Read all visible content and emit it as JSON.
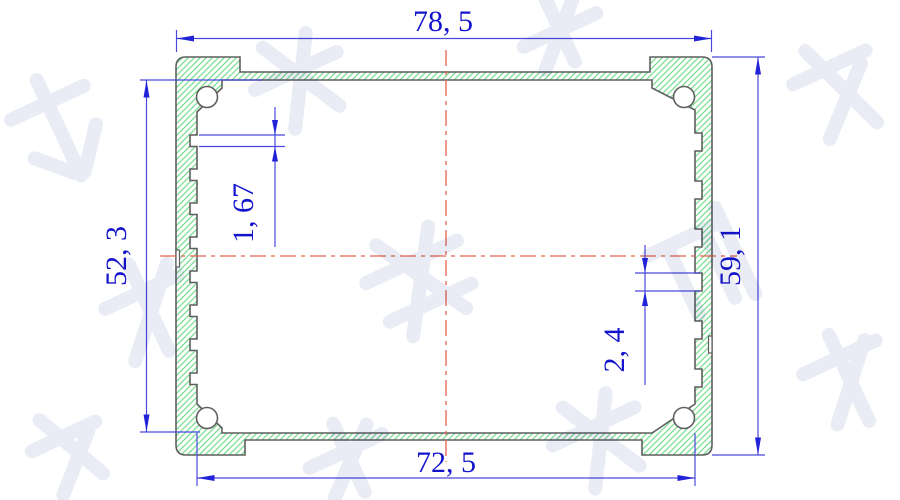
{
  "drawing": {
    "dims": {
      "top_width": "78, 5",
      "bottom_width": "72, 5",
      "left_height": "52, 3",
      "right_height": "59, 1",
      "left_groove_width": "1, 67",
      "right_groove_width": "2, 4"
    },
    "watermark": {
      "text": "鸿发顺达"
    },
    "colors": {
      "dimension_blue": "#1414cc",
      "line_blue": "#4a4add",
      "hatch_green": "#78dc8c",
      "outline_gray": "#5f5f5f",
      "centerline_red": "#e8604f",
      "watermark_gray": "#e9ebf5"
    }
  }
}
